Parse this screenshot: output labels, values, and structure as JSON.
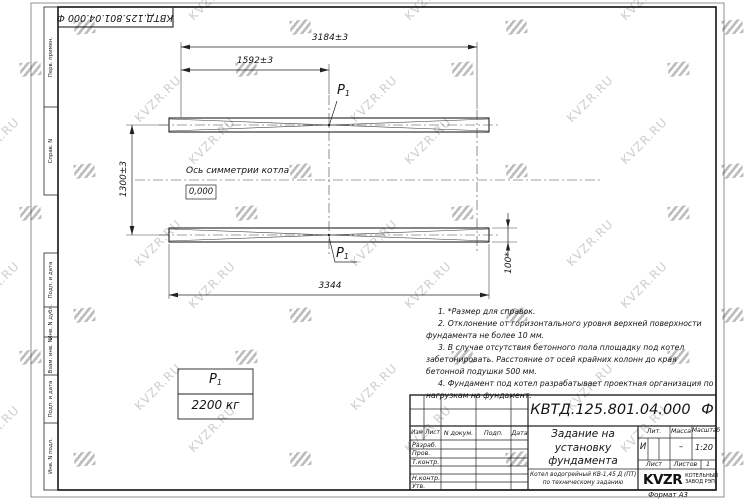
{
  "stamp": {
    "text": "КВТД.125.801.04.000 Ф"
  },
  "margin": {
    "labels": [
      "Перв. примен.",
      "Справ. N",
      "Подп. и дата",
      "Инв. N дубл.",
      "Взам. инв. N",
      "Подп. и дата",
      "Инв. N подл."
    ]
  },
  "watermark": {
    "text": "KVZR.RU"
  },
  "drawing": {
    "dim_top_full": "3184±3",
    "dim_top_half": "1592±3",
    "dim_left": "1300±3",
    "dim_bottom": "3344",
    "dim_right": "100*",
    "axis_label": "Ось симметрии котла",
    "level_mark": "0,000",
    "load_symbol": "P",
    "load_sub": "1"
  },
  "load_table": {
    "symbol": "P",
    "symbol_sub": "1",
    "value": "2200 кг"
  },
  "notes": [
    "1. *Размер для справок.",
    "2. Отклонение от горизонтального уровня верхней поверхности фундамента не более 10 мм.",
    "3. В случае отсутствия бетонного пола площадку под котел забетонировать. Расстояние от осей крайних колонн до края бетонной подушки 500 мм.",
    "4. Фундамент под котел разрабатывает проектная организация по нагрузкам на фундамент."
  ],
  "title_block": {
    "doc_number": "КВТД.125.801.04.000 Ф",
    "title": "Задание на установку фундамента",
    "product_line1": "Котел водогрейный КВ-1,45 Д (ПТ)",
    "product_line2": "по техническому заданию",
    "header_cols": [
      "Изм",
      "Лист",
      "N докум.",
      "Подп.",
      "Дата"
    ],
    "sign_rows": [
      "Разраб.",
      "Пров.",
      "Т.контр.",
      "Н.контр.",
      "Утв."
    ],
    "lit_label": "Лит.",
    "mass_label": "Масса",
    "scale_label": "Масштаб",
    "lit_value": "И",
    "mass_value": "–",
    "scale_value": "1:20",
    "sheet_label": "Лист",
    "sheets_label": "Листов",
    "sheets_value": "1",
    "company_name": "KVZR",
    "company_line1": "КОТЕЛЬНЫЙ",
    "company_line2": "ЗАВОД РЭП",
    "format_note": "Формат А3"
  }
}
